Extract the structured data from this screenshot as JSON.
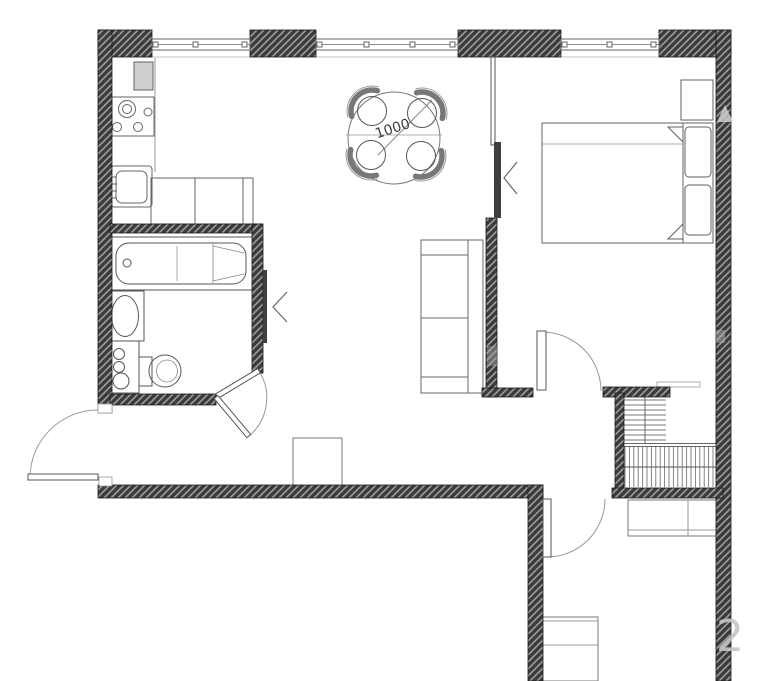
{
  "plan": {
    "type": "apartment-floor-plan",
    "dining_table_label": "1000",
    "watermark_text": "2",
    "colors": {
      "wall_fill": "#3b3b3b",
      "wall_hatch": "#9c9c9c",
      "outline": "#555555",
      "appliance_fill": "#cfcfcf",
      "background": "#ffffff",
      "watermark": "#c6c6c6"
    },
    "rooms": [
      "kitchen-living-room",
      "bedroom",
      "bathroom",
      "entrance-hall",
      "wardrobe-closet",
      "lower-corridor"
    ],
    "fixtures": [
      "refrigerator",
      "gas-stove",
      "kitchen-sink",
      "kitchen-counter",
      "dining-table",
      "dining-chairs-x4",
      "bathtub",
      "washbasin",
      "washing-machine",
      "toilet",
      "sofa",
      "double-bed",
      "pillows-x2",
      "nightstand",
      "wardrobe-shelves",
      "wardrobe-hanging-rail",
      "hall-cabinet",
      "corridor-cabinet",
      "corridor-furniture"
    ],
    "openings": [
      "entrance-door",
      "bathroom-door",
      "bedroom-door",
      "corridor-door",
      "window-kitchen",
      "window-living",
      "window-bedroom"
    ]
  }
}
